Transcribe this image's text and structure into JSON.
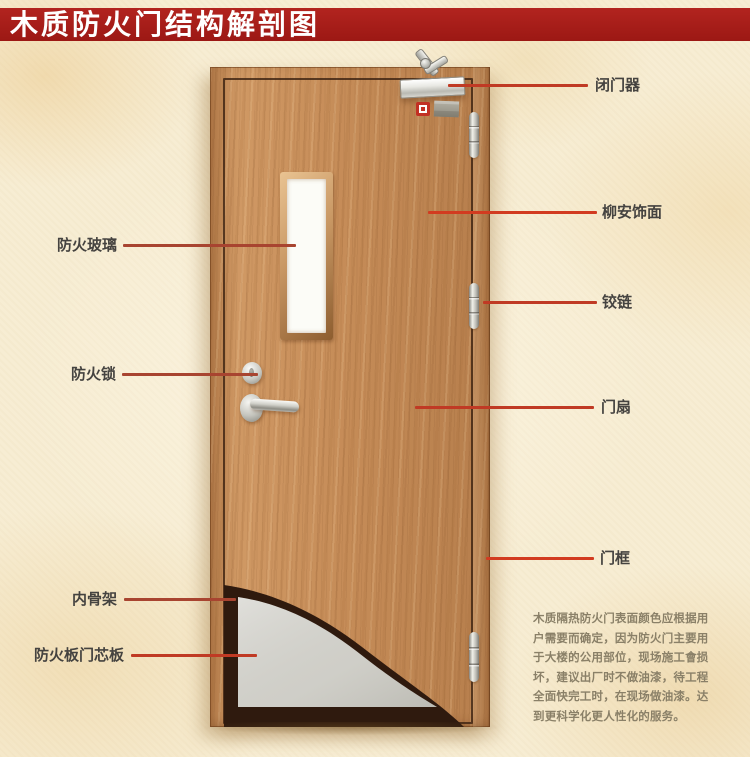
{
  "title": "木质防火门结构解剖图",
  "labels": {
    "door_closer": "闭门器",
    "lauan_veneer": "柳安饰面",
    "hinge": "铰链",
    "door_leaf": "门扇",
    "door_frame": "门框",
    "fire_glass": "防火玻璃",
    "fire_lock": "防火锁",
    "inner_frame": "内骨架",
    "fire_board_core": "防火板门芯板"
  },
  "description": "木质隔热防火门表面颜色应根据用户需要而确定，因为防火门主要用于大楼的公用部位，现场施工會损坏，建议出厂时不做油漆，待工程全面快完工时，在现场做油漆。达到更科学化更人性化的服务。",
  "colors": {
    "title_bar_red": "#a91e1b",
    "leader_line_red": "#c03a24",
    "door_wood": "#c98f5a",
    "core_panel_gray": "#d6d5cf",
    "inner_skeleton_dark": "#2f1a0e",
    "background_cream": "#f7edd3",
    "label_text": "#454340",
    "description_text": "#8a8068"
  }
}
